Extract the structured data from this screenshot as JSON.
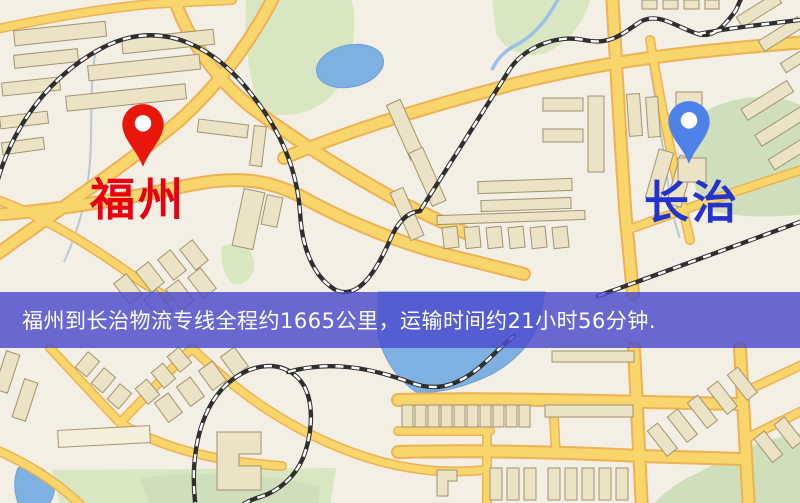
{
  "map": {
    "origin": {
      "name": "福州",
      "label_color": "#e60012",
      "pin_color": "#e9160b"
    },
    "destination": {
      "name": "长治",
      "label_color": "#2433cc",
      "pin_color": "#4f82e8"
    },
    "banner": {
      "text": "福州到长治物流专线全程约1665公里，运输时间约21小时56分钟.",
      "background_color": "#4b4bcd",
      "text_color": "#ffffff"
    },
    "route": {
      "service": "物流专线",
      "distance": "约1665公里",
      "transport_time": "约21小时56分钟"
    },
    "legend_colors": {
      "background": "#f4efe4",
      "road_fill": "#f8d66b",
      "road_casing": "#edb156",
      "water": "#7fb0e2",
      "park_green": "#d8e6c2",
      "building": "#ece2c6",
      "building_outline": "#a29370",
      "railway_dark": "#2f2f2f",
      "railway_dash": "#ffffff"
    }
  }
}
